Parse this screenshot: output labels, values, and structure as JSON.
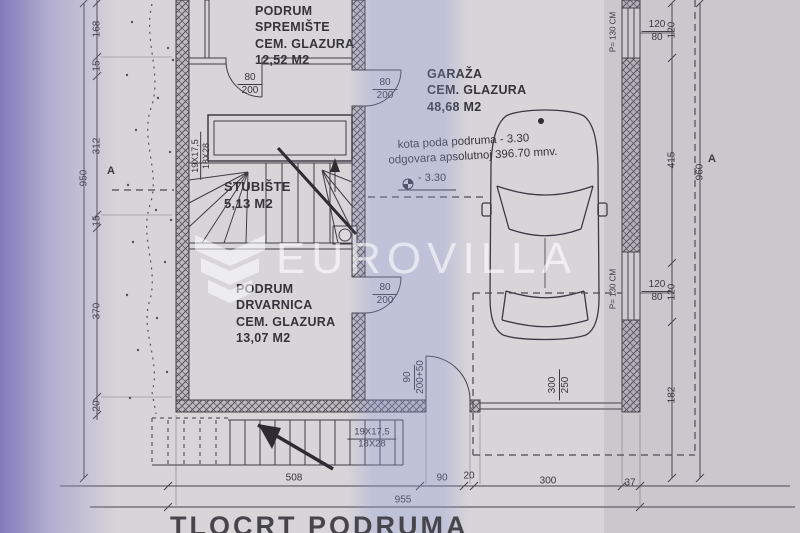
{
  "photo": {
    "paper_color": "#d8d5d9",
    "tint_left": "#7c76ba",
    "tint_mid": "#8a98d4"
  },
  "watermark": {
    "brand": "EUROVILLA",
    "logo": "chevron-shield"
  },
  "title": "TLOCRT PODRUMA",
  "rooms": {
    "spremiste": {
      "lines": [
        "PODRUM",
        "SPREMIŠTE",
        "CEM. GLAZURA",
        "12,52 M2"
      ]
    },
    "stubiste": {
      "lines": [
        "STUBIŠTE",
        "5,13 M2"
      ]
    },
    "drvarnica": {
      "lines": [
        "PODRUM",
        "DRVARNICA",
        "CEM. GLAZURA",
        "13,07 M2"
      ]
    },
    "garaza": {
      "lines": [
        "GARAŽA",
        "CEM. GLAZURA",
        "48,68 M2"
      ]
    }
  },
  "notes": {
    "kota_line1": "kota poda podruma - 3.30",
    "kota_line2": "odgovara apsolutnoj 396.70 mnv.",
    "level_mark": "- 3.30"
  },
  "doors": {
    "standard": {
      "num": "80",
      "den": "200"
    },
    "entry": {
      "num": "90",
      "den": "200+50"
    },
    "garage": {
      "num": "300",
      "den": "250"
    }
  },
  "windows": {
    "label": {
      "num": "120",
      "den": "80"
    },
    "parapet": "P= 130 CM"
  },
  "stairs": {
    "risers": "19X17,5",
    "treads": "18X28"
  },
  "dims": {
    "left_total": "950",
    "left_chain": [
      "168",
      "15",
      "312",
      "15",
      "370",
      "20"
    ],
    "right_total": "960",
    "right_chain": [
      "120",
      "415",
      "120",
      "182"
    ],
    "bottom_chain": [
      "508",
      "90",
      "20",
      "300",
      "37"
    ],
    "bottom_total": "955",
    "section_marker": "A"
  }
}
